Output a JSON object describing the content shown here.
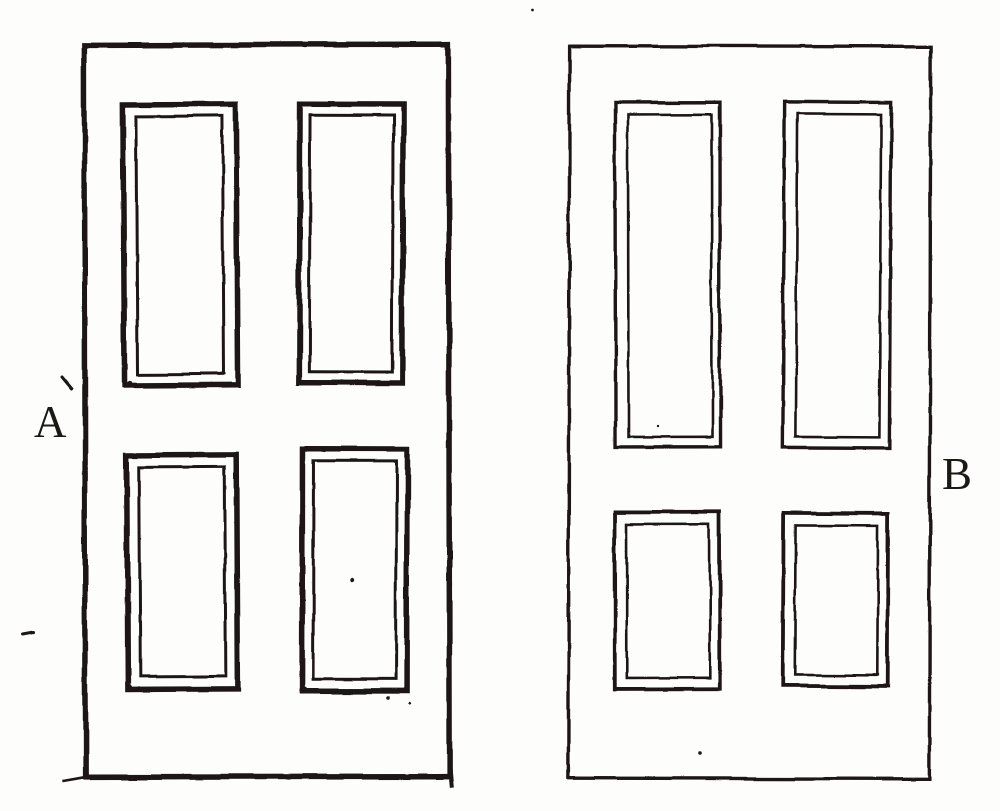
{
  "figure": {
    "description": "Hand-drawn line illustration comparing two four-panel doors",
    "door_a": {
      "label": "A"
    },
    "door_b": {
      "label": "B"
    },
    "colors": {
      "ink": "#1b1914",
      "paper": "#fdfdfc"
    }
  }
}
